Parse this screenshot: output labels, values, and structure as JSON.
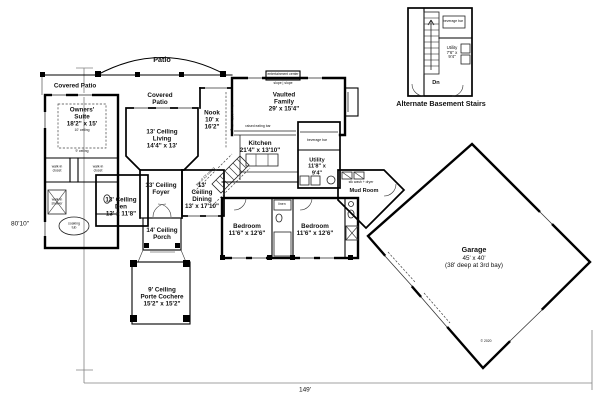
{
  "dimensions": {
    "height": "80'10\"",
    "width": "149'"
  },
  "outdoor": {
    "patio": "Patio",
    "covered_patio_left": "Covered Patio",
    "covered_patio_center": "Covered\nPatio",
    "porch": "14' Ceiling\nPorch",
    "porte_cochere": "9' Ceiling\nPorte Cochere\n15'2\" x 15'2\""
  },
  "rooms": {
    "owners_suite": "Owners'\nSuite\n18'2\" x 15'",
    "owners_tray_ceiling": "10' ceiling",
    "owners_ceiling": "9' ceiling",
    "living": "13' Ceiling\nLiving\n14'4\" x 13'",
    "nook": "Nook\n10' x\n16'2\"",
    "family": "Vaulted\nFamily\n29' x 15'4\"",
    "kitchen": "Kitchen\n21'4\" x 13'10\"",
    "dining": "13'\nCeiling\nDining\n13' x 17'10\"",
    "foyer": "13' Ceiling\nFoyer",
    "den": "13' Ceiling\nDen\n13' x 11'8\"",
    "bedroom_left": "Bedroom\n11'6\" x 12'6\"",
    "bedroom_right": "Bedroom\n11'6\" x 12'6\"",
    "utility": "Utility\n11'8\" x\n9'4\"",
    "mud_room": "Mud Room",
    "garage_name": "Garage",
    "garage_dims": "45' x 40'\n(38' deep at 3rd bay)"
  },
  "fixtures": {
    "walk_in_closet_1": "walk-in\ncloset",
    "walk_in_closet_2": "walk-in\ncloset",
    "walk_in_shower": "walk-in\nshower",
    "soaking_tub": "soaking\ntub",
    "linen": "linen",
    "beverage_bar": "beverage bar",
    "raised_eating_bar": "raised eating bar",
    "entertainment_center": "entertainment center",
    "slope": "slope | slope",
    "wash_dryer": "stk wash + dryer",
    "ceiling_line_1": "line of 13' ceiling",
    "ceiling_line_2": "line of 13' ceiling"
  },
  "inset": {
    "caption": "Alternate Basement Stairs",
    "utility": "Utility\n7'6\" x\n9'4\"",
    "dn": "Dn",
    "beverage_bar": "beverage bar"
  },
  "copyright": "© 2020"
}
